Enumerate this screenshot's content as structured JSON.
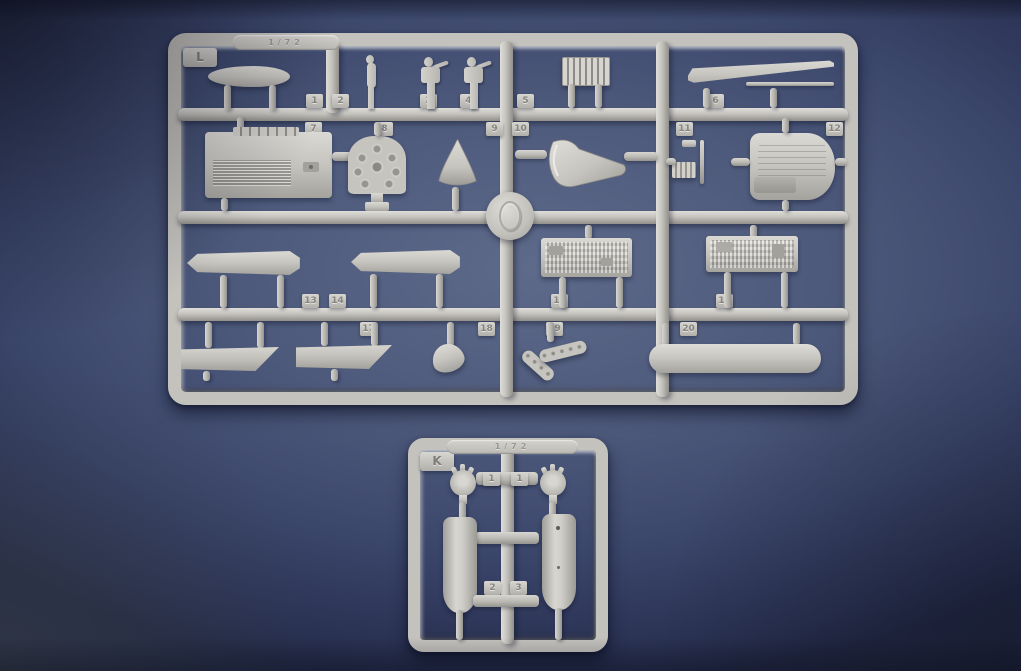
{
  "scene": {
    "type": "product-photo",
    "subject": "two light-grey injection-moulded plastic model-kit sprues on a dark blue backdrop"
  },
  "colors": {
    "background_center": "#4d597b",
    "background_corner": "#232a47",
    "plastic_base": "#c6c4bf",
    "plastic_highlight": "#e0ded9",
    "plastic_shadow": "#928f8a",
    "cast_shadow": "#1a2140"
  },
  "sprue_l": {
    "label": "L",
    "marking": "1/72",
    "top_tabs": [
      "1",
      "2",
      "3",
      "4",
      "5",
      "6"
    ],
    "mid_tabs": [
      "7",
      "8",
      "9",
      "10",
      "11",
      "12"
    ],
    "upper_tabs": [
      "13",
      "14",
      "15",
      "16"
    ],
    "lower_tabs": [
      "17",
      "18",
      "19",
      "20"
    ],
    "parts": [
      "streamlined-fairing",
      "standing-crew-figure",
      "gunner-figure",
      "gunner-figure",
      "radiator-grille",
      "tapered-boom",
      "engine-block",
      "radial-engine-bank",
      "spinner-cone",
      "cowling-scoop",
      "small-bracket",
      "engine-cowl-panel",
      "float-torpedo-shape",
      "float-torpedo-shape",
      "detail-panel",
      "detail-panel",
      "angled-flat-plate",
      "angled-flat-plate",
      "small-nose-cone",
      "curved-duct",
      "drop-tank"
    ]
  },
  "sprue_k": {
    "label": "K",
    "marking": "1/72",
    "engine_tabs": [
      "1",
      "1"
    ],
    "lower_tabs": [
      "2",
      "3"
    ],
    "parts": [
      "small-radial-engine",
      "small-radial-engine",
      "tapered-cylinder",
      "tapered-cylinder-with-holes"
    ]
  }
}
